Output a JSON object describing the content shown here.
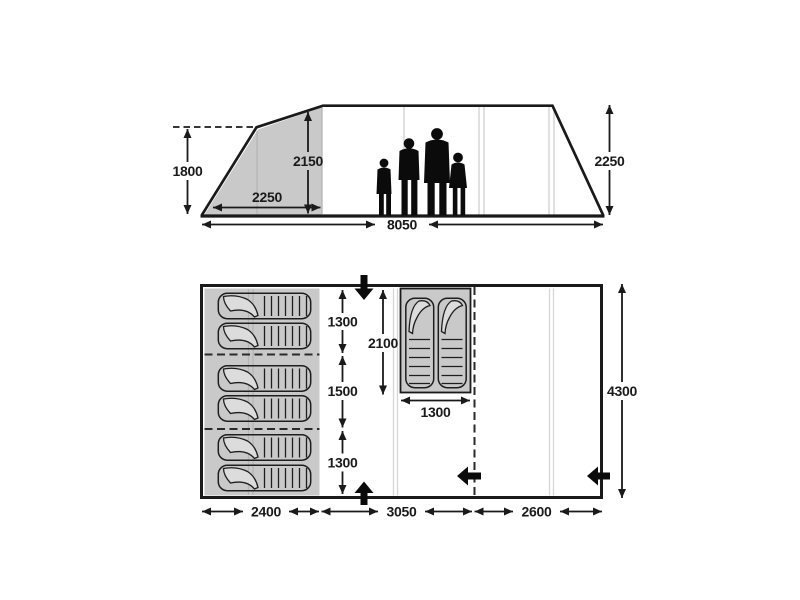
{
  "colors": {
    "line": "#1a1a1a",
    "shaded_area": "#c9c9c9",
    "pole_line": "#cccccc",
    "silhouette": "#0b0b0b",
    "background": "#ffffff"
  },
  "elevation": {
    "labels": {
      "left_height": "1800",
      "inner_height": "2150",
      "porch_width": "2250",
      "right_height": "2250",
      "total_length": "8050"
    },
    "icons": {
      "figures": "family-silhouette"
    }
  },
  "floorplan": {
    "labels": {
      "left_column": [
        "1300",
        "1500",
        "1300"
      ],
      "inner_bedroom_length": "2100",
      "inner_bedroom_width": "1300",
      "total_depth": "4300",
      "bottom_row": [
        "2400",
        "3050",
        "2600"
      ]
    },
    "icons": {
      "entrance_top": "arrow-down",
      "entrance_bottom": "arrow-up",
      "entrance_divider": "arrow-left",
      "entrance_right": "arrow-left",
      "bed": "sleeping-bag"
    }
  }
}
